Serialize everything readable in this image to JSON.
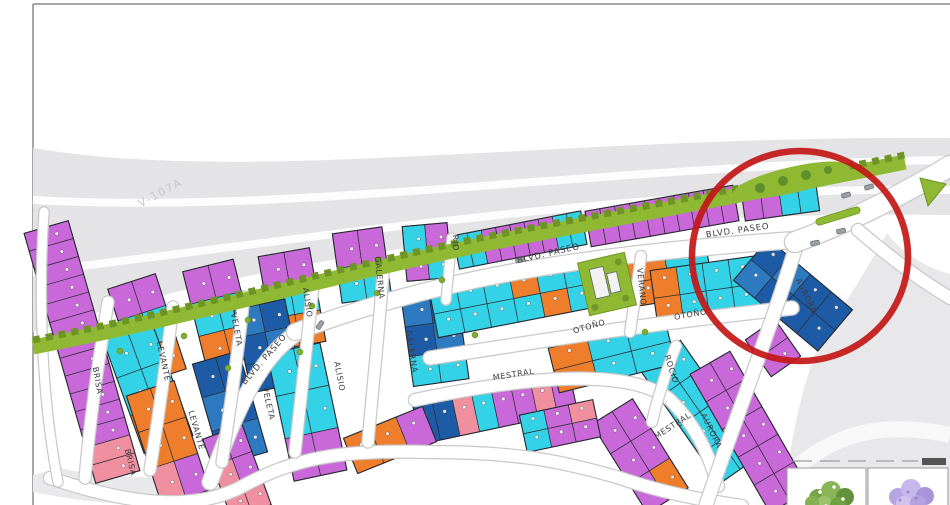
{
  "map": {
    "highway_label": "V-107A",
    "palette": {
      "M": "#c968d8",
      "C": "#33d2e6",
      "O": "#ee7e2b",
      "B": "#1e5ba6",
      "b": "#2e7ac0",
      "P": "#ef8fa0"
    },
    "colors": {
      "green_strip": "#8fb932",
      "green_dark": "#6e9427",
      "road_gray": "#e4e4e7",
      "terrain": "#e8e8ea",
      "outline": "#2b2f36",
      "label": "#3c3c3c",
      "circle": "#c21717"
    },
    "highlight_circle": {
      "cx": 800,
      "cy": 256,
      "rx": 108,
      "ry": 105
    },
    "street_labels": [
      {
        "t": "BRISA",
        "x": 95,
        "y": 381,
        "r": 80,
        "cls": "street-label"
      },
      {
        "t": "BRISA",
        "x": 128,
        "y": 463,
        "r": 76,
        "cls": "street-label"
      },
      {
        "t": "LEVANTE",
        "x": 161,
        "y": 362,
        "r": 78,
        "cls": "street-label"
      },
      {
        "t": "LEVANTE",
        "x": 194,
        "y": 431,
        "r": 74,
        "cls": "street-label"
      },
      {
        "t": "VELETA",
        "x": 234,
        "y": 330,
        "r": 80,
        "cls": "street-label"
      },
      {
        "t": "VELETA",
        "x": 266,
        "y": 404,
        "r": 77,
        "cls": "street-label"
      },
      {
        "t": "ALISIO",
        "x": 305,
        "y": 303,
        "r": 82,
        "cls": "street-label"
      },
      {
        "t": "ALISIO",
        "x": 337,
        "y": 377,
        "r": 79,
        "cls": "street-label"
      },
      {
        "t": "GALERNA",
        "x": 377,
        "y": 278,
        "r": 84,
        "cls": "street-label"
      },
      {
        "t": "GALERNA",
        "x": 409,
        "y": 352,
        "r": 81,
        "cls": "street-label"
      },
      {
        "t": "RIO",
        "x": 453,
        "y": 243,
        "r": 87,
        "cls": "street-label"
      },
      {
        "t": "BLVD. PASEO",
        "x": 266,
        "y": 361,
        "r": -49,
        "cls": "blvd-label"
      },
      {
        "t": "BLVD. PASEO",
        "x": 549,
        "y": 256,
        "r": -13,
        "cls": "blvd-label"
      },
      {
        "t": "BLVD. PASEO",
        "x": 738,
        "y": 233,
        "r": -8,
        "cls": "blvd-label"
      },
      {
        "t": "OTOÑO",
        "x": 590,
        "y": 329,
        "r": -16,
        "cls": "street-label"
      },
      {
        "t": "OTOÑO",
        "x": 691,
        "y": 317,
        "r": -10,
        "cls": "street-label"
      },
      {
        "t": "MESTRAL",
        "x": 514,
        "y": 377,
        "r": -9,
        "cls": "street-label"
      },
      {
        "t": "MESTRAL",
        "x": 674,
        "y": 428,
        "r": -33,
        "cls": "street-label"
      },
      {
        "t": "VERANO",
        "x": 639,
        "y": 287,
        "r": 84,
        "cls": "street-label"
      },
      {
        "t": "ROCIO",
        "x": 669,
        "y": 370,
        "r": 72,
        "cls": "street-label"
      },
      {
        "t": "AURORA",
        "x": 804,
        "y": 297,
        "r": 64,
        "cls": "street-label"
      },
      {
        "t": "AURORA",
        "x": 709,
        "y": 432,
        "r": 64,
        "cls": "street-label"
      }
    ],
    "blocks": [
      {
        "cx": 82,
        "cy": 352,
        "rot": 74,
        "len": 260,
        "dep": 46,
        "rows": [
          [
            "M",
            "M",
            "M",
            "M",
            "M",
            "M",
            "M",
            "M",
            "M",
            "M",
            "M",
            "M",
            "P",
            "P"
          ]
        ]
      },
      {
        "cx": 147,
        "cy": 329,
        "rot": 72,
        "len": 100,
        "dep": 50,
        "rows": [
          [
            "M",
            "C",
            "O"
          ],
          [
            "M",
            "C",
            "O"
          ]
        ]
      },
      {
        "cx": 220,
        "cy": 314,
        "rot": 76,
        "len": 100,
        "dep": 52,
        "rows": [
          [
            "M",
            "C",
            "O"
          ],
          [
            "M",
            "C",
            "O"
          ]
        ]
      },
      {
        "cx": 292,
        "cy": 299,
        "rot": 80,
        "len": 95,
        "dep": 52,
        "rows": [
          [
            "M",
            "C",
            "O"
          ],
          [
            "M",
            "C",
            "O"
          ]
        ]
      },
      {
        "cx": 362,
        "cy": 265,
        "rot": 82,
        "len": 70,
        "dep": 50,
        "rows": [
          [
            "M",
            "C"
          ],
          [
            "M",
            "C"
          ]
        ]
      },
      {
        "cx": 427,
        "cy": 252,
        "rot": 85,
        "len": 55,
        "dep": 45,
        "rows": [
          [
            "M",
            "C"
          ],
          [
            "C",
            "M"
          ]
        ]
      },
      {
        "cx": 148,
        "cy": 388,
        "rot": 70,
        "len": 120,
        "dep": 52,
        "rows": [
          [
            "C",
            "C",
            "O"
          ],
          [
            "C",
            "C",
            "O"
          ]
        ]
      },
      {
        "cx": 168,
        "cy": 443,
        "rot": 72,
        "len": 115,
        "dep": 50,
        "rows": [
          [
            "O",
            "O",
            "M"
          ],
          [
            "O",
            "O",
            "P"
          ]
        ]
      },
      {
        "cx": 268,
        "cy": 346,
        "rot": 78,
        "len": 85,
        "dep": 52,
        "rows": [
          [
            "B",
            "b",
            "B"
          ],
          [
            "b",
            "B",
            "B"
          ]
        ]
      },
      {
        "cx": 307,
        "cy": 412,
        "rot": 78,
        "len": 130,
        "dep": 54,
        "rows": [
          [
            "C",
            "C",
            "M"
          ],
          [
            "C",
            "C",
            "M"
          ]
        ]
      },
      {
        "cx": 435,
        "cy": 338,
        "rot": 82,
        "len": 90,
        "dep": 56,
        "rows": [
          [
            "B",
            "b",
            "C"
          ],
          [
            "b",
            "B",
            "C"
          ]
        ]
      },
      {
        "cx": 230,
        "cy": 408,
        "rot": 74,
        "len": 105,
        "dep": 48,
        "rows": [
          [
            "B",
            "B",
            "b"
          ],
          [
            "B",
            "b",
            "B"
          ]
        ]
      },
      {
        "cx": 237,
        "cy": 472,
        "rot": 70,
        "len": 85,
        "dep": 42,
        "rows": [
          [
            "M",
            "M",
            "P"
          ],
          [
            "M",
            "P",
            "P"
          ]
        ]
      },
      {
        "cx": 495,
        "cy": 408,
        "rot": -12,
        "len": 160,
        "dep": 40,
        "rows": [
          [
            "B",
            "B",
            "P",
            "C",
            "M",
            "M",
            "P",
            "M"
          ]
        ]
      },
      {
        "cx": 527,
        "cy": 296,
        "rot": -11,
        "len": 190,
        "dep": 48,
        "rows": [
          [
            "C",
            "C",
            "C",
            "O",
            "C",
            "C",
            "O"
          ],
          [
            "C",
            "C",
            "C",
            "C",
            "O",
            "C",
            "C"
          ]
        ]
      },
      {
        "cx": 668,
        "cy": 277,
        "rot": -9,
        "len": 85,
        "dep": 48,
        "rows": [
          [
            "O",
            "C"
          ],
          [
            "O",
            "C"
          ]
        ]
      },
      {
        "cx": 706,
        "cy": 291,
        "rot": -8,
        "len": 105,
        "dep": 56,
        "rows": [
          [
            "O",
            "C",
            "C",
            "C"
          ],
          [
            "O",
            "C",
            "C",
            "C"
          ]
        ]
      },
      {
        "cx": 793,
        "cy": 295,
        "rot": 40,
        "len": 110,
        "dep": 54,
        "rows": [
          [
            "B",
            "b",
            "B",
            "B"
          ],
          [
            "b",
            "B",
            "B",
            "B"
          ]
        ]
      },
      {
        "cx": 773,
        "cy": 348,
        "rot": 55,
        "len": 45,
        "dep": 36,
        "rows": [
          [
            "M",
            "M"
          ]
        ]
      },
      {
        "cx": 700,
        "cy": 412,
        "rot": 55,
        "len": 140,
        "dep": 50,
        "rows": [
          [
            "C",
            "C",
            "C",
            "C"
          ],
          [
            "C",
            "C",
            "C",
            "C"
          ]
        ]
      },
      {
        "cx": 750,
        "cy": 432,
        "rot": 60,
        "len": 160,
        "dep": 46,
        "rows": [
          [
            "M",
            "M",
            "M",
            "M",
            "M"
          ],
          [
            "M",
            "M",
            "M",
            "M",
            "M"
          ]
        ]
      },
      {
        "cx": 612,
        "cy": 356,
        "rot": -14,
        "len": 120,
        "dep": 46,
        "rows": [
          [
            "O",
            "C",
            "C"
          ],
          [
            "O",
            "C",
            "C"
          ]
        ]
      },
      {
        "cx": 640,
        "cy": 456,
        "rot": 58,
        "len": 105,
        "dep": 48,
        "rows": [
          [
            "M",
            "M",
            "O"
          ],
          [
            "M",
            "M",
            "M"
          ]
        ]
      },
      {
        "cx": 560,
        "cy": 426,
        "rot": -12,
        "len": 75,
        "dep": 38,
        "rows": [
          [
            "C",
            "M",
            "P"
          ],
          [
            "C",
            "M",
            "M"
          ]
        ]
      },
      {
        "cx": 390,
        "cy": 440,
        "rot": -22,
        "len": 85,
        "dep": 38,
        "rows": [
          [
            "O",
            "O",
            "M"
          ]
        ]
      },
      {
        "cx": 520,
        "cy": 240,
        "rot": -11,
        "len": 130,
        "dep": 34,
        "rows": [
          [
            "C",
            "C",
            "M",
            "M",
            "M",
            "M",
            "M",
            "C",
            "C"
          ]
        ]
      },
      {
        "cx": 662,
        "cy": 216,
        "rot": -10,
        "len": 150,
        "dep": 36,
        "rows": [
          [
            "M",
            "M",
            "M",
            "M",
            "M",
            "M",
            "M",
            "M",
            "M",
            "M"
          ]
        ]
      },
      {
        "cx": 780,
        "cy": 198,
        "rot": -8,
        "len": 75,
        "dep": 36,
        "rows": [
          [
            "M",
            "M",
            "C",
            "C"
          ]
        ]
      }
    ],
    "legend": {
      "panels": [
        {
          "name": "green-tree"
        },
        {
          "name": "jacaranda-tree"
        }
      ]
    }
  }
}
